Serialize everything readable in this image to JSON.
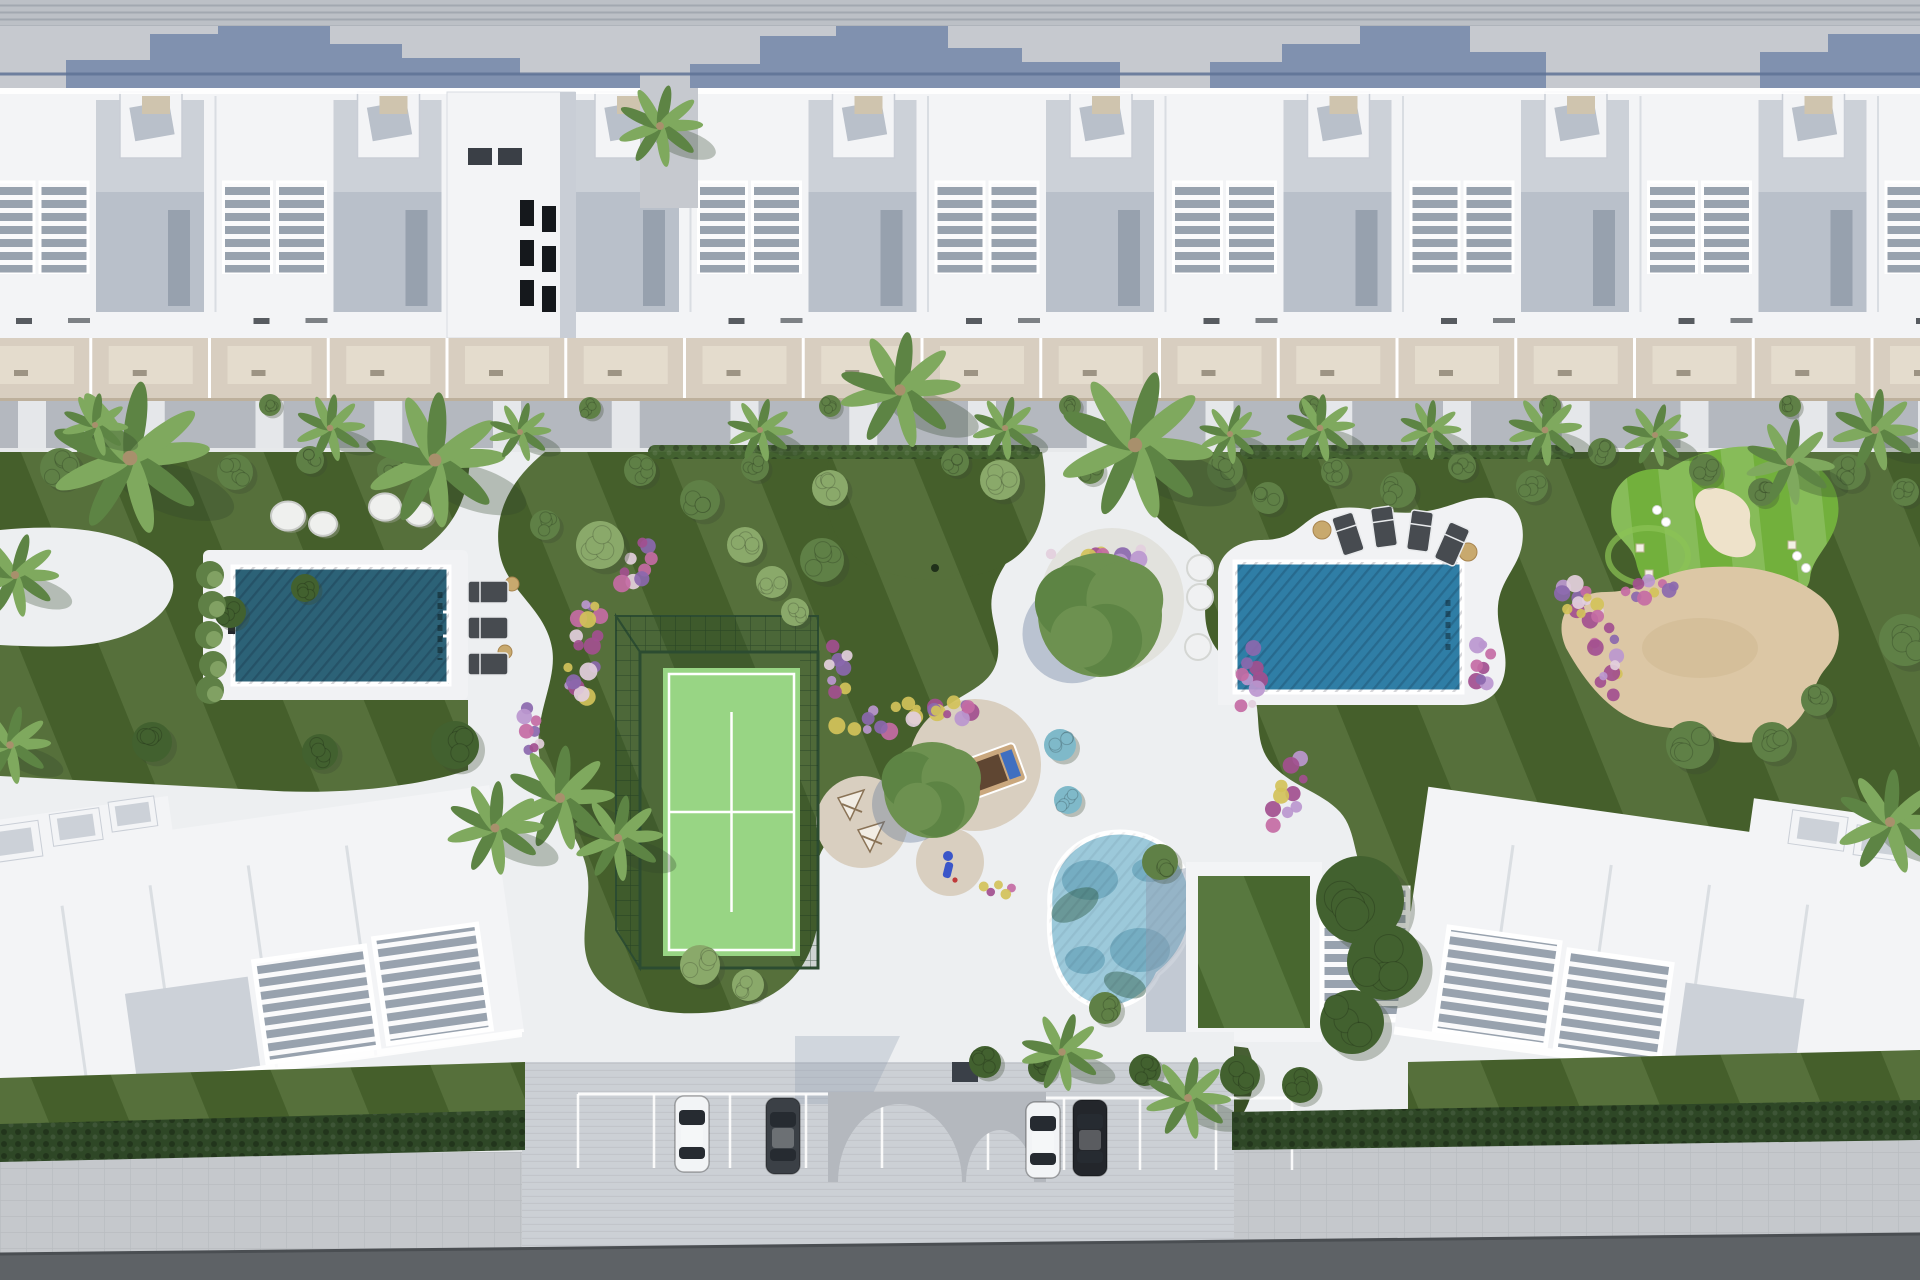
{
  "meta": {
    "description": "aerial-3d-render-residential-resort-site-plan",
    "width": 1920,
    "height": 1280
  },
  "palette": {
    "paving_top": "#c6c9cf",
    "corr_band": "#bcc0c6",
    "shadow_blue": "#7d8fae",
    "rail_line": "#5f7396",
    "building_white": "#f3f4f6",
    "building_shadow": "#c9ced6",
    "roof_deck": "#b9c0ca",
    "roof_deck_light": "#ccd1d8",
    "pergola_floor": "#98a2ae",
    "window_dark": "#15181c",
    "roofbox_tan": "#cfc4ae",
    "terrace_beige": "#d8cec0",
    "terrace_light": "#e4dccd",
    "terrace_edge": "#bdb09c",
    "street_gray": "#b4b8bf",
    "curb_white": "#e7e9eb",
    "path_white": "#edeff1",
    "lawn": "#4b672f",
    "lawn_dark": "#3c5526",
    "pool_deep": "#2c6277",
    "pool_bright": "#2f7ea6",
    "pool_light": "#9cc9da",
    "pool_lagoon_deep": "#4f93ac",
    "deck_white": "#f1f2f4",
    "padel_court": "#98d584",
    "padel_cage": "#2c4c31",
    "patio_gravel": "#d9cfc0",
    "island_gravel": "#e2e2dd",
    "golf_green": "#72b03c",
    "golf_collar": "#8cc355",
    "bunker_sand": "#eee2ca",
    "sand": "#dcc7a5",
    "sand_shade": "#cdb68d",
    "flower_pink": "#c46ba4",
    "flower_magenta": "#a24f8f",
    "flower_purple": "#8b68ae",
    "flower_lilac": "#bb97cf",
    "flower_yellow": "#d3c25a",
    "flower_white": "#e3cfdd",
    "bush_dark": "#42612f",
    "bush_mid": "#5f8046",
    "bush_light": "#8aa96a",
    "bush_aqua": "#7fb9c9",
    "palm_green": "#7fa95e",
    "palm_dark": "#5d8444",
    "palm_trunk": "#a8906c",
    "stone_white": "#eff0ee",
    "stone_shade": "#c9cbc8",
    "lounger_dark": "#474b50",
    "lounger_frame": "#e8eaec",
    "pouf_tan": "#c8a96e",
    "pouf_white": "#f0f1f2",
    "clubhouse_roof": "#4e7033",
    "arch_gray": "#b4b8be",
    "parking_pave": "#ccd0d5",
    "stall_line": "#ffffff",
    "car_white": "#f2f4f6",
    "car_dark": "#3b4046",
    "car_black": "#23262b",
    "car_glass": "#262b31",
    "hedge_dark": "#2e4726",
    "sidewalk": "#c5c8cc",
    "road": "#5e6266",
    "bed_frame": "#caa87e",
    "bed_cushion": "#5f4632",
    "bed_pillow": "#3f6fc0",
    "tent_canvas": "#f2ede4",
    "tent_frame": "#8a7356",
    "toy_blue": "#3a56c9"
  },
  "scene": {
    "units": {
      "count": 9,
      "x0": -28,
      "w": 237.5
    },
    "tower": {
      "x": 447,
      "y": 92,
      "w": 128,
      "h": 246
    },
    "palms": [
      [
        130,
        458,
        82
      ],
      [
        15,
        575,
        45
      ],
      [
        10,
        745,
        42
      ],
      [
        435,
        460,
        72
      ],
      [
        900,
        390,
        62
      ],
      [
        1135,
        445,
        80
      ],
      [
        660,
        126,
        44
      ],
      [
        95,
        425,
        34
      ],
      [
        330,
        428,
        36
      ],
      [
        520,
        432,
        32
      ],
      [
        760,
        430,
        34
      ],
      [
        1005,
        428,
        34
      ],
      [
        1230,
        434,
        32
      ],
      [
        1320,
        428,
        36
      ],
      [
        1430,
        430,
        32
      ],
      [
        1545,
        430,
        38
      ],
      [
        1655,
        435,
        34
      ],
      [
        1875,
        430,
        44
      ],
      [
        1790,
        462,
        46
      ],
      [
        560,
        798,
        56
      ],
      [
        618,
        838,
        46
      ],
      [
        495,
        828,
        50
      ],
      [
        1062,
        1052,
        42
      ],
      [
        1188,
        1098,
        44
      ],
      [
        1890,
        822,
        56
      ]
    ],
    "bushes": [
      [
        60,
        468,
        20,
        1
      ],
      [
        150,
        455,
        16,
        1
      ],
      [
        235,
        472,
        18,
        1
      ],
      [
        310,
        460,
        14,
        1
      ],
      [
        390,
        470,
        13,
        1
      ],
      [
        455,
        745,
        24,
        0
      ],
      [
        320,
        752,
        18,
        0
      ],
      [
        152,
        742,
        20,
        0
      ],
      [
        230,
        612,
        16,
        0
      ],
      [
        305,
        588,
        14,
        0
      ],
      [
        600,
        545,
        24,
        2
      ],
      [
        545,
        525,
        15,
        1
      ],
      [
        640,
        470,
        16,
        1
      ],
      [
        700,
        500,
        20,
        1
      ],
      [
        755,
        467,
        14,
        1
      ],
      [
        822,
        560,
        22,
        1
      ],
      [
        745,
        545,
        18,
        2
      ],
      [
        772,
        582,
        16,
        2
      ],
      [
        795,
        612,
        14,
        2
      ],
      [
        830,
        488,
        18,
        2
      ],
      [
        1000,
        480,
        20,
        2
      ],
      [
        955,
        462,
        14,
        1
      ],
      [
        1090,
        470,
        14,
        1
      ],
      [
        1060,
        745,
        16,
        3
      ],
      [
        1068,
        800,
        14,
        3
      ],
      [
        1225,
        470,
        18,
        1
      ],
      [
        1268,
        498,
        16,
        1
      ],
      [
        1335,
        472,
        14,
        1
      ],
      [
        1398,
        490,
        18,
        1
      ],
      [
        1462,
        466,
        14,
        1
      ],
      [
        1532,
        486,
        16,
        1
      ],
      [
        1602,
        452,
        14,
        1
      ],
      [
        1705,
        470,
        16,
        1
      ],
      [
        1762,
        492,
        14,
        1
      ],
      [
        1848,
        472,
        18,
        1
      ],
      [
        1905,
        492,
        14,
        1
      ],
      [
        1690,
        745,
        24,
        1
      ],
      [
        1772,
        742,
        20,
        1
      ],
      [
        1905,
        640,
        26,
        1
      ],
      [
        1817,
        700,
        16,
        1
      ],
      [
        1360,
        900,
        44,
        0
      ],
      [
        1385,
        962,
        38,
        0
      ],
      [
        1352,
        1022,
        32,
        0
      ],
      [
        1160,
        862,
        18,
        1
      ],
      [
        1105,
        1008,
        16,
        1
      ],
      [
        1240,
        1075,
        20,
        0
      ],
      [
        1300,
        1085,
        18,
        0
      ],
      [
        1145,
        1070,
        16,
        0
      ],
      [
        985,
        1062,
        16,
        0
      ],
      [
        1042,
        1068,
        14,
        0
      ],
      [
        700,
        965,
        20,
        2
      ],
      [
        748,
        985,
        16,
        2
      ],
      [
        270,
        405,
        11,
        1
      ],
      [
        590,
        408,
        11,
        1
      ],
      [
        830,
        406,
        11,
        1
      ],
      [
        1070,
        406,
        11,
        1
      ],
      [
        1310,
        406,
        11,
        1
      ],
      [
        1550,
        406,
        11,
        1
      ],
      [
        1790,
        406,
        11,
        1
      ]
    ],
    "hedgerows": [
      [
        648,
        1040,
        452
      ],
      [
        1240,
        1575,
        452
      ]
    ],
    "trees": [
      [
        1100,
        615,
        62
      ],
      [
        932,
        790,
        48
      ]
    ],
    "flower_colors": [
      "flower_pink",
      "flower_magenta",
      "flower_purple",
      "flower_lilac",
      "flower_yellow",
      "flower_white"
    ],
    "flower_clusters": [
      [
        585,
        645,
        30,
        130,
        8,
        18
      ],
      [
        636,
        565,
        26,
        54,
        30,
        9
      ],
      [
        532,
        732,
        24,
        56,
        -14,
        8
      ],
      [
        905,
        716,
        140,
        26,
        -10,
        16
      ],
      [
        838,
        668,
        26,
        56,
        0,
        8
      ],
      [
        1100,
        556,
        100,
        24,
        0,
        12
      ],
      [
        952,
        712,
        40,
        20,
        0,
        6
      ],
      [
        1248,
        678,
        26,
        64,
        8,
        9
      ],
      [
        1288,
        792,
        30,
        76,
        18,
        10
      ],
      [
        1482,
        668,
        22,
        56,
        0,
        8
      ],
      [
        1598,
        646,
        36,
        120,
        -22,
        18
      ],
      [
        1580,
        600,
        30,
        60,
        -55,
        10
      ],
      [
        1648,
        590,
        54,
        24,
        -8,
        9
      ],
      [
        998,
        888,
        30,
        18,
        0,
        5
      ]
    ],
    "stones": [
      [
        288,
        516,
        17
      ],
      [
        323,
        524,
        14
      ],
      [
        385,
        507,
        16
      ],
      [
        419,
        514,
        14
      ]
    ],
    "poufs": [
      [
        1200,
        568,
        13
      ],
      [
        1200,
        597,
        13
      ],
      [
        1198,
        647,
        13
      ]
    ],
    "side_tables": [
      [
        512,
        584,
        7
      ],
      [
        505,
        652,
        7
      ],
      [
        1322,
        530,
        9
      ],
      [
        1468,
        552,
        9
      ]
    ],
    "loungers_left": [
      [
        488,
        592
      ],
      [
        488,
        628
      ],
      [
        488,
        664
      ]
    ],
    "loungers_right": [
      [
        1348,
        534,
        -18
      ],
      [
        1384,
        527,
        -8
      ],
      [
        1420,
        531,
        8
      ],
      [
        1452,
        544,
        24
      ]
    ],
    "cars": [
      [
        692,
        1134,
        "car_white"
      ],
      [
        783,
        1136,
        "car_dark"
      ],
      [
        1043,
        1140,
        "car_white"
      ],
      [
        1090,
        1138,
        "car_black"
      ]
    ],
    "stall_groups": [
      [
        578,
        4,
        76,
        1094,
        74
      ],
      [
        988,
        4,
        76,
        1098,
        72
      ]
    ],
    "golf_balls": [
      [
        1657,
        510
      ],
      [
        1666,
        522
      ],
      [
        1797,
        556
      ],
      [
        1806,
        568
      ]
    ],
    "golf_markers": [
      [
        1640,
        548
      ],
      [
        1649,
        574
      ],
      [
        1792,
        545
      ]
    ]
  }
}
